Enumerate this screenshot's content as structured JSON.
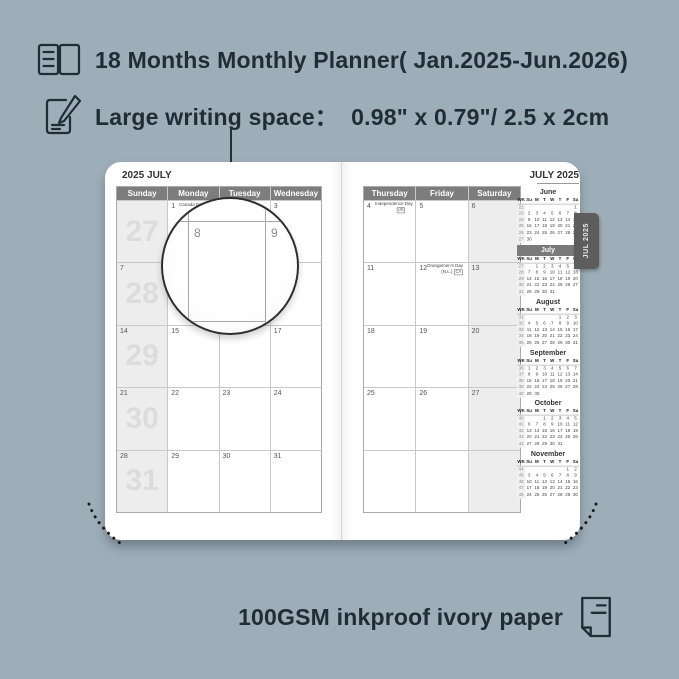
{
  "colors": {
    "background": "#9EAEB8",
    "page": "#FFFFFF",
    "header_bar": "#7D7D7D",
    "shaded_column": "#EDEDED",
    "tab": "#5D5D5D",
    "text_dark": "#222C35"
  },
  "features": [
    {
      "icon": "notebook-icon",
      "text": "18 Months Monthly Planner( Jan.2025-Jun.2026)"
    },
    {
      "icon": "pencil-note-icon",
      "text": "Large writing space：  0.98\" x 0.79\"/ 2.5 x 2cm"
    }
  ],
  "footer": {
    "icon": "paper-icon",
    "text": "100GSM inkproof ivory paper"
  },
  "magnifier": {
    "cell_date": "8",
    "adjacent_date": "9"
  },
  "planner": {
    "tab_label": "JUL 2025",
    "left_page": {
      "title": "2025 JULY",
      "day_headers": [
        "Sunday",
        "Monday",
        "Tuesday",
        "Wednesday"
      ],
      "weeks": [
        {
          "week_number": "27",
          "cells": [
            {
              "date": ""
            },
            {
              "date": "1",
              "note": "Canada Day",
              "badge": "CA",
              "badge_pos": "inline"
            },
            {
              "date": "2"
            },
            {
              "date": "3"
            }
          ]
        },
        {
          "week_number": "28",
          "cells": [
            {
              "date": "7"
            },
            {
              "date": "8"
            },
            {
              "date": "9"
            },
            {
              "date": "10"
            }
          ]
        },
        {
          "week_number": "29",
          "cells": [
            {
              "date": "14"
            },
            {
              "date": "15"
            },
            {
              "date": "16"
            },
            {
              "date": "17"
            }
          ]
        },
        {
          "week_number": "30",
          "cells": [
            {
              "date": "21"
            },
            {
              "date": "22"
            },
            {
              "date": "23"
            },
            {
              "date": "24"
            }
          ]
        },
        {
          "week_number": "31",
          "cells": [
            {
              "date": "28"
            },
            {
              "date": "29"
            },
            {
              "date": "30"
            },
            {
              "date": "31"
            }
          ]
        }
      ]
    },
    "right_page": {
      "title": "JULY 2025",
      "day_headers": [
        "Thursday",
        "Friday",
        "Saturday"
      ],
      "weeks": [
        {
          "cells": [
            {
              "date": "4",
              "note": "Independence Day",
              "badge": "US",
              "badge_pos": "below"
            },
            {
              "date": "5"
            },
            {
              "date": "6"
            }
          ]
        },
        {
          "cells": [
            {
              "date": "11"
            },
            {
              "date": "12",
              "note": "Orangemen's Day",
              "note2": "(N.L.)",
              "badge": "CA",
              "badge_pos": "line2"
            },
            {
              "date": "13"
            }
          ]
        },
        {
          "cells": [
            {
              "date": "18"
            },
            {
              "date": "19"
            },
            {
              "date": "20"
            }
          ]
        },
        {
          "cells": [
            {
              "date": "25"
            },
            {
              "date": "26"
            },
            {
              "date": "27"
            }
          ]
        },
        {
          "cells": [
            {
              "date": ""
            },
            {
              "date": ""
            },
            {
              "date": ""
            }
          ]
        }
      ]
    },
    "mini_calendars": {
      "header": [
        "WK",
        "Su",
        "M",
        "T",
        "W",
        "T",
        "F",
        "Sa"
      ],
      "months": [
        {
          "name": "June",
          "highlight": false,
          "rows": [
            [
              "22",
              "",
              "",
              "",
              "",
              "",
              "",
              "1"
            ],
            [
              "23",
              "2",
              "3",
              "4",
              "5",
              "6",
              "7",
              "8"
            ],
            [
              "24",
              "9",
              "10",
              "11",
              "12",
              "13",
              "14",
              "15"
            ],
            [
              "25",
              "16",
              "17",
              "18",
              "19",
              "20",
              "21",
              "22"
            ],
            [
              "26",
              "23",
              "24",
              "25",
              "26",
              "27",
              "28",
              "29"
            ],
            [
              "27",
              "30",
              "",
              "",
              "",
              "",
              "",
              ""
            ]
          ]
        },
        {
          "name": "July",
          "highlight": true,
          "rows": [
            [
              "27",
              "",
              "1",
              "2",
              "3",
              "4",
              "5",
              "6"
            ],
            [
              "28",
              "7",
              "8",
              "9",
              "10",
              "11",
              "12",
              "13"
            ],
            [
              "29",
              "14",
              "15",
              "16",
              "17",
              "18",
              "19",
              "20"
            ],
            [
              "30",
              "21",
              "22",
              "23",
              "24",
              "25",
              "26",
              "27"
            ],
            [
              "31",
              "28",
              "29",
              "30",
              "31",
              "",
              "",
              ""
            ]
          ]
        },
        {
          "name": "August",
          "highlight": false,
          "rows": [
            [
              "31",
              "",
              "",
              "",
              "",
              "1",
              "2",
              "3"
            ],
            [
              "32",
              "4",
              "5",
              "6",
              "7",
              "8",
              "9",
              "10"
            ],
            [
              "33",
              "11",
              "12",
              "13",
              "14",
              "15",
              "16",
              "17"
            ],
            [
              "34",
              "18",
              "19",
              "20",
              "21",
              "22",
              "23",
              "24"
            ],
            [
              "35",
              "25",
              "26",
              "27",
              "28",
              "29",
              "30",
              "31"
            ]
          ]
        },
        {
          "name": "September",
          "highlight": false,
          "rows": [
            [
              "36",
              "1",
              "2",
              "3",
              "4",
              "5",
              "6",
              "7"
            ],
            [
              "37",
              "8",
              "9",
              "10",
              "11",
              "12",
              "13",
              "14"
            ],
            [
              "38",
              "15",
              "16",
              "17",
              "18",
              "19",
              "20",
              "21"
            ],
            [
              "39",
              "22",
              "23",
              "24",
              "25",
              "26",
              "27",
              "28"
            ],
            [
              "40",
              "29",
              "30",
              "",
              "",
              "",
              "",
              ""
            ]
          ]
        },
        {
          "name": "October",
          "highlight": false,
          "rows": [
            [
              "40",
              "",
              "",
              "1",
              "2",
              "3",
              "4",
              "5"
            ],
            [
              "41",
              "6",
              "7",
              "8",
              "9",
              "10",
              "11",
              "12"
            ],
            [
              "42",
              "13",
              "14",
              "15",
              "16",
              "17",
              "18",
              "19"
            ],
            [
              "43",
              "20",
              "21",
              "22",
              "23",
              "24",
              "25",
              "26"
            ],
            [
              "44",
              "27",
              "28",
              "29",
              "30",
              "31",
              "",
              ""
            ]
          ]
        },
        {
          "name": "November",
          "highlight": false,
          "rows": [
            [
              "44",
              "",
              "",
              "",
              "",
              "",
              "1",
              "2"
            ],
            [
              "45",
              "3",
              "4",
              "5",
              "6",
              "7",
              "8",
              "9"
            ],
            [
              "46",
              "10",
              "11",
              "12",
              "13",
              "14",
              "15",
              "16"
            ],
            [
              "47",
              "17",
              "18",
              "19",
              "20",
              "21",
              "22",
              "23"
            ],
            [
              "48",
              "24",
              "25",
              "26",
              "27",
              "28",
              "29",
              "30"
            ]
          ]
        }
      ]
    }
  }
}
